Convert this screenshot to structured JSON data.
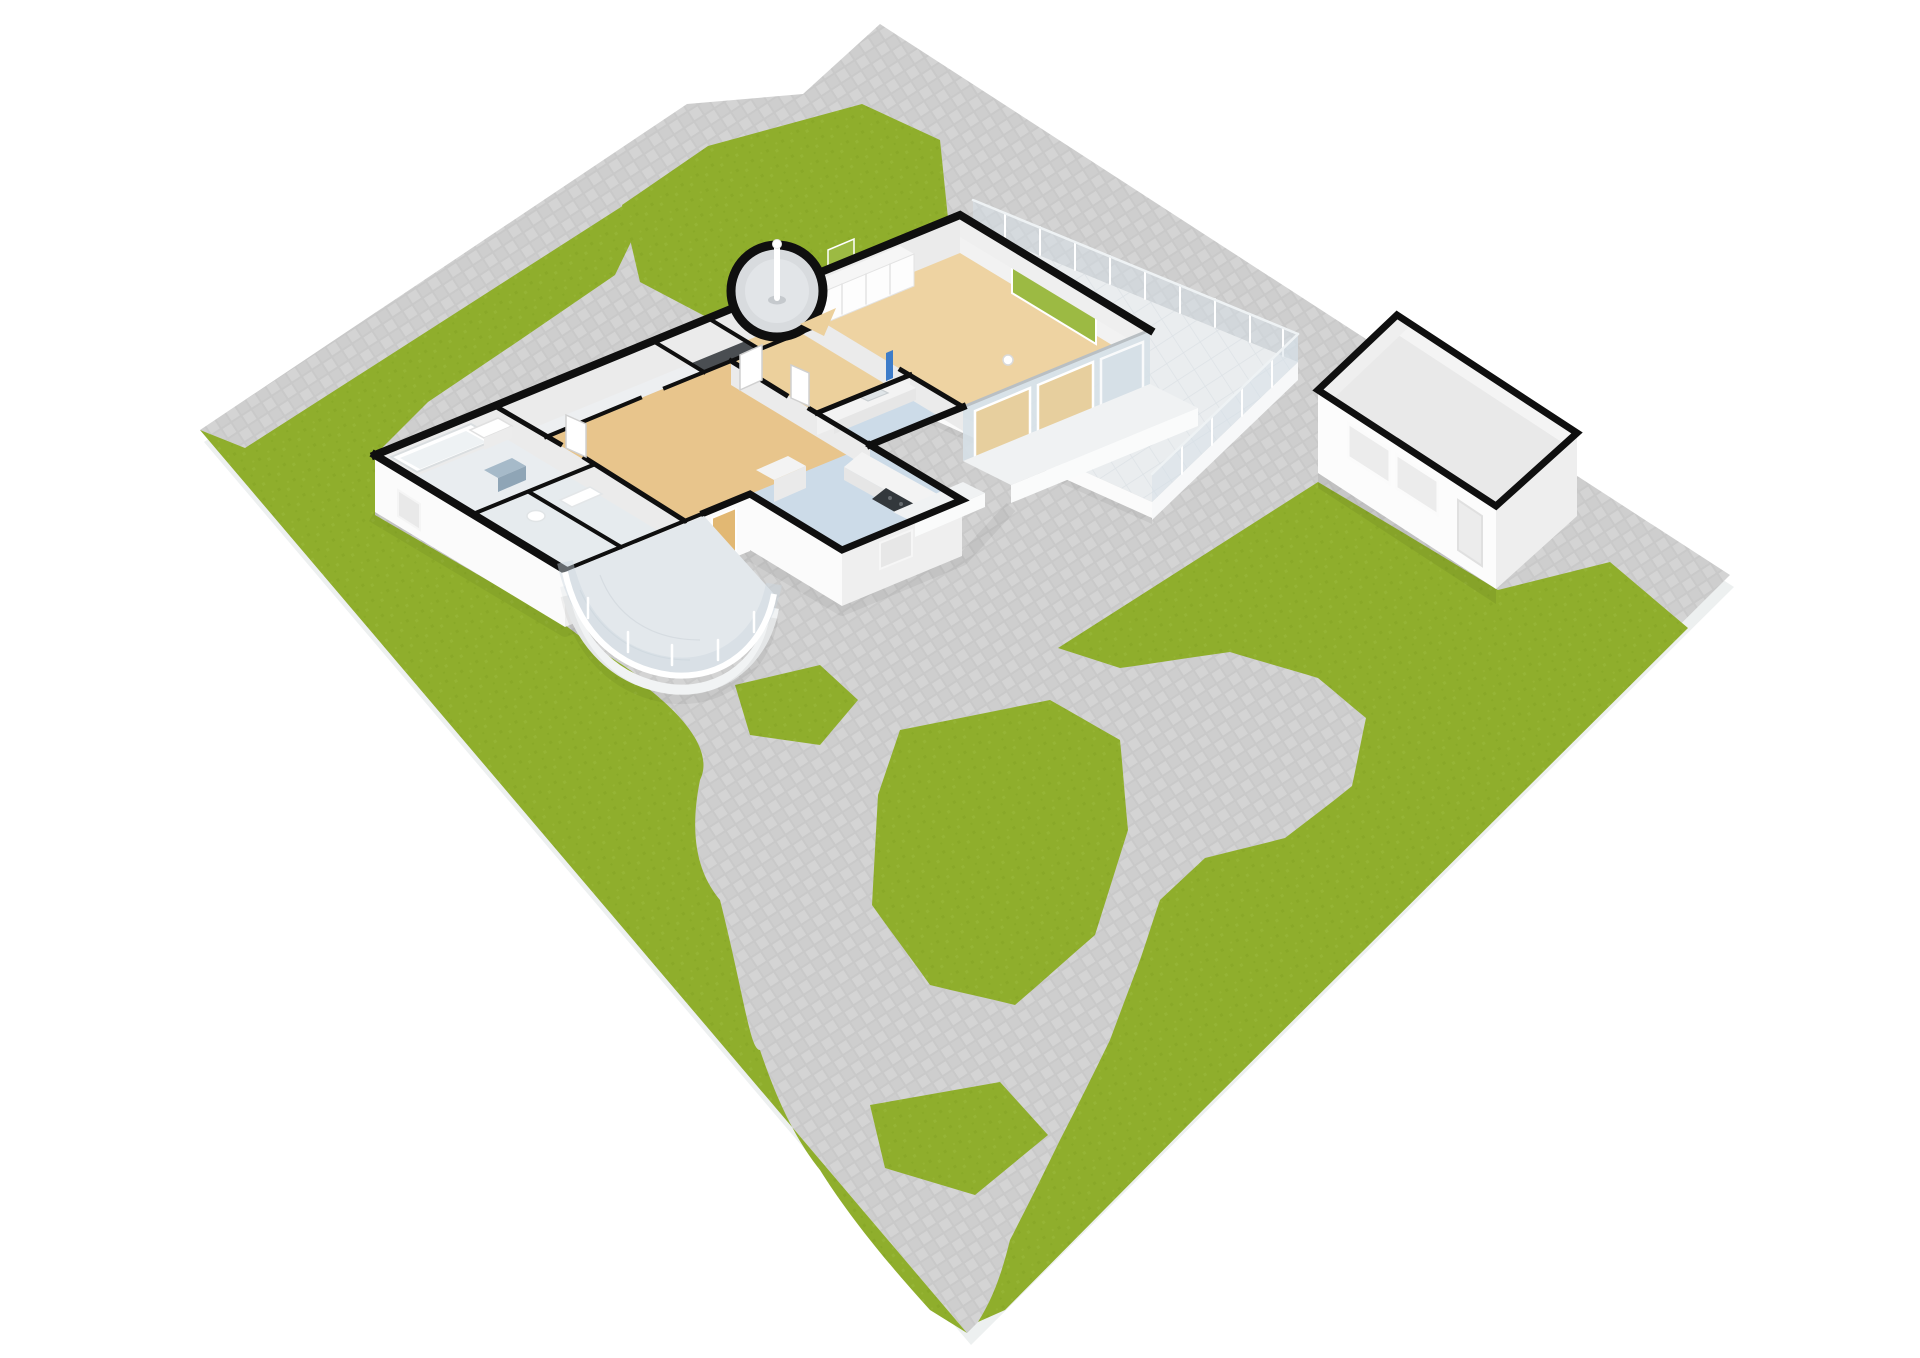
{
  "scene": {
    "type": "3d-floorplan-site-render",
    "camera": "high-angle-orbit",
    "buildings": [
      "main-house",
      "garage"
    ],
    "rooms": [
      "living-room",
      "hallway",
      "kitchen",
      "bedroom",
      "bathroom",
      "wc",
      "storage",
      "turret-stair"
    ],
    "outdoor": [
      "lawn",
      "paving",
      "roof-terrace",
      "curved-conservatory-terrace",
      "garden-paths"
    ],
    "lamp_count": 1
  },
  "colors": {
    "background": "#ffffff",
    "plot_edge": "#edf0f0",
    "paving_base": "#c9c9c9",
    "paving_tile": "#d4d4d4",
    "paving_tile_alt": "#cecece",
    "grass": "#8fae2c",
    "grass_dark": "#84a324",
    "grass_light": "#9bb93d",
    "wall_top": "#0f0f0f",
    "wall_ext": "#fbfbfb",
    "wall_ext_shade": "#efefef",
    "wall_inner": "#ebebeb",
    "wall_inner_lit": "#f2f2f2",
    "floor_living": "#eed3a2",
    "floor_hall": "#ecd09c",
    "floor_bedroom": "#e8c58c",
    "floor_kitchen": "#ccdbe8",
    "floor_bath": "#e9edf0",
    "floor_bath2": "#e6ebee",
    "floor_corridor": "#edeff1",
    "floor_dark": "#4a4e52",
    "floor_turret": "#d8dbde",
    "terrace_tile": "#eaedef",
    "terrace_line": "#dde2e6",
    "terrace_fascia": "#f7f8f9",
    "glass": "#d6e0e7",
    "window_green": "#9cba43",
    "door_tan": "#e2b873",
    "pane_tan": "#e7cf9e",
    "accent_blue": "#3d7cc9",
    "cabinet_blue": "#a6bac9",
    "cabinet_blue_dark": "#8fa5b6",
    "counter_white": "#f3f3f3",
    "counter_front": "#e6e6e6",
    "cooktop_dark": "#33383c",
    "fixture_white": "#ffffff",
    "step_top": "#f0f2f3",
    "step_front": "#fafbfb",
    "garage_floor": "#e9e9e9",
    "garage_inner": "#f4f4f4",
    "garage_inner2": "#efefef",
    "garage_wall": "#fcfcfc",
    "garage_wall_shade": "#eeeeee",
    "garage_window": "#ececec",
    "bay_floor": "#e3e8ec",
    "shadow": "#000000"
  }
}
